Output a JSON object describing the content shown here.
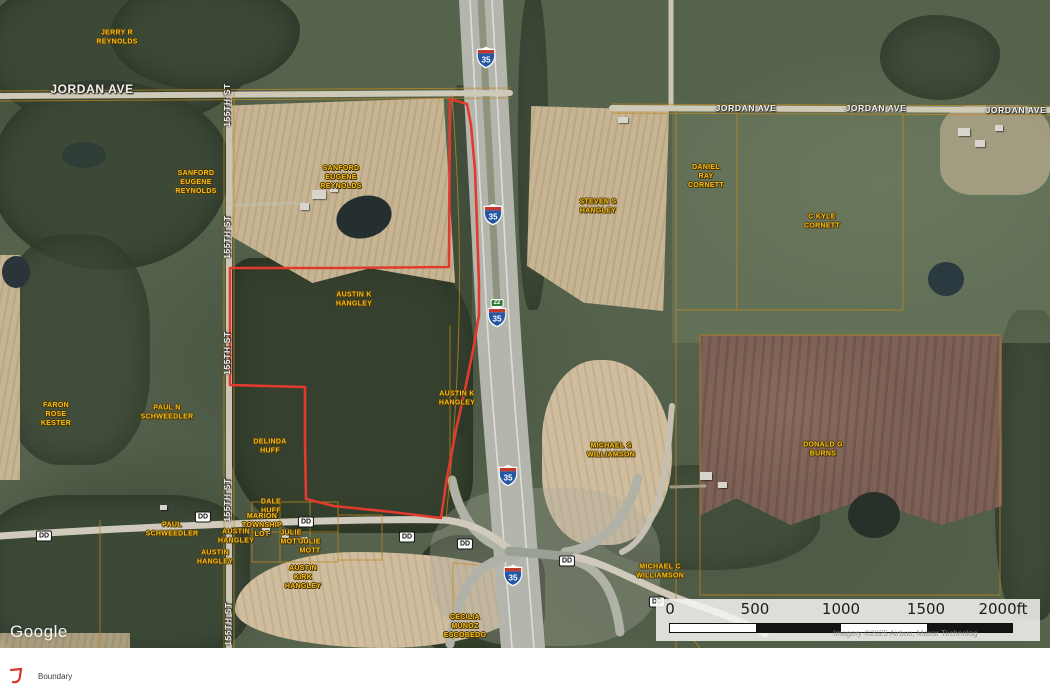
{
  "map": {
    "google_watermark": "Google",
    "attribution": "Imagery ©2025 Airbus, Maxar Technolog",
    "owner_label_color": "#f2c01d",
    "owner_labels": [
      {
        "name": "parcel-label-jerry-r-reynolds",
        "text": "JERRY R\nREYNOLDS",
        "x": 117,
        "y": 38
      },
      {
        "name": "parcel-label-sanford-eugene-reynolds-1",
        "text": "SANFORD\nEUGENE\nREYNOLDS",
        "x": 196,
        "y": 183
      },
      {
        "name": "parcel-label-sanford-eugene-reynolds-2",
        "text": "SANFORD\nEUGENE\nREYNOLDS",
        "x": 341,
        "y": 178
      },
      {
        "name": "parcel-label-steven-s-hangley",
        "text": "STEVEN S\nHANGLEY",
        "x": 598,
        "y": 207
      },
      {
        "name": "parcel-label-daniel-ray-cornett",
        "text": "DANIEL\nRAY\nCORNETT",
        "x": 706,
        "y": 177
      },
      {
        "name": "parcel-label-c-kyle-cornett",
        "text": "C KYLE\nCORNETT",
        "x": 822,
        "y": 222
      },
      {
        "name": "parcel-label-austin-k-hangley-1",
        "text": "AUSTIN K\nHANGLEY",
        "x": 354,
        "y": 300
      },
      {
        "name": "parcel-label-austin-k-hangley-2",
        "text": "AUSTIN K\nHANGLEY",
        "x": 457,
        "y": 399
      },
      {
        "name": "parcel-label-michael-s-williamson",
        "text": "MICHAEL S\nWILLIAMSON",
        "x": 611,
        "y": 451
      },
      {
        "name": "parcel-label-donald-g-burns",
        "text": "DONALD G\nBURNS",
        "x": 823,
        "y": 450
      },
      {
        "name": "parcel-label-faron-rose-kester",
        "text": "FARON\nROSE\nKESTER",
        "x": 56,
        "y": 415
      },
      {
        "name": "parcel-label-paul-n-schweedler",
        "text": "PAUL N\nSCHWEEDLER",
        "x": 167,
        "y": 413
      },
      {
        "name": "parcel-label-delinda-huff",
        "text": "DELINDA\nHUFF",
        "x": 270,
        "y": 447
      },
      {
        "name": "parcel-label-dale-huff",
        "text": "DALE\nHUFF",
        "x": 271,
        "y": 507
      },
      {
        "name": "parcel-label-paul-schweedler",
        "text": "PAUL\nSCHWEEDLER",
        "x": 172,
        "y": 530
      },
      {
        "name": "parcel-label-marion-township-lot",
        "text": "MARION\nTOWNSHIP\nLOT",
        "x": 262,
        "y": 526
      },
      {
        "name": "parcel-label-austin-hangley-1",
        "text": "AUSTIN\nHANGLEY",
        "x": 236,
        "y": 537
      },
      {
        "name": "parcel-label-julie-mott-1",
        "text": "JULIE\nMOTT",
        "x": 291,
        "y": 538
      },
      {
        "name": "parcel-label-julie-mott-2",
        "text": "JULIE\nMOTT",
        "x": 310,
        "y": 547
      },
      {
        "name": "parcel-label-austin-hangley-2",
        "text": "AUSTIN\nHANGLEY",
        "x": 215,
        "y": 558
      },
      {
        "name": "parcel-label-austin-kirk-hangley",
        "text": "AUSTIN\nKIRK\nHANGLEY",
        "x": 303,
        "y": 578
      },
      {
        "name": "parcel-label-michael-c-williamson",
        "text": "MICHAEL C\nWILLIAMSON",
        "x": 660,
        "y": 572
      },
      {
        "name": "parcel-label-cecilia-munoz-escobedo",
        "text": "CECILIA\nMUNOZ\nESCOBEDO",
        "x": 465,
        "y": 627
      }
    ],
    "road_labels": [
      {
        "name": "road-label-jordan-ave-west",
        "text": "JORDAN AVE",
        "x": 92,
        "y": 89,
        "size": 12,
        "rotate": 0
      },
      {
        "name": "road-label-jordan-ave-east-1",
        "text": "JORDAN AVE",
        "x": 746,
        "y": 108,
        "size": 8.5,
        "rotate": 0
      },
      {
        "name": "road-label-jordan-ave-east-2",
        "text": "JORDAN AVE",
        "x": 876,
        "y": 108,
        "size": 8.5,
        "rotate": 0
      },
      {
        "name": "road-label-jordan-ave-east-3",
        "text": "JORDAN AVE",
        "x": 1016,
        "y": 110,
        "size": 8.5,
        "rotate": 0
      },
      {
        "name": "road-label-155th-st-1",
        "text": "155TH ST",
        "x": 227,
        "y": 105,
        "size": 8.5,
        "rotate": -90
      },
      {
        "name": "road-label-155th-st-2",
        "text": "155TH ST",
        "x": 227,
        "y": 237,
        "size": 8.5,
        "rotate": -90
      },
      {
        "name": "road-label-155th-st-3",
        "text": "155TH ST",
        "x": 227,
        "y": 353,
        "size": 8.5,
        "rotate": -90
      },
      {
        "name": "road-label-155th-st-4",
        "text": "155TH ST",
        "x": 227,
        "y": 500,
        "size": 8.5,
        "rotate": -90
      },
      {
        "name": "road-label-155th-st-5",
        "text": "155TH ST",
        "x": 228,
        "y": 624,
        "size": 8.5,
        "rotate": -90
      }
    ],
    "dd_badge_label": "DD",
    "dd_badges": [
      {
        "x": 44,
        "y": 536
      },
      {
        "x": 203,
        "y": 517
      },
      {
        "x": 306,
        "y": 522
      },
      {
        "x": 407,
        "y": 537
      },
      {
        "x": 465,
        "y": 544
      },
      {
        "x": 567,
        "y": 561
      },
      {
        "x": 657,
        "y": 602
      }
    ],
    "interstate_shield": {
      "route": "35"
    },
    "interstate_shield_positions": [
      {
        "x": 486,
        "y": 60
      },
      {
        "x": 493,
        "y": 217
      },
      {
        "x": 497,
        "y": 319
      },
      {
        "x": 508,
        "y": 478
      },
      {
        "x": 513,
        "y": 578
      }
    ],
    "exit_badge": {
      "label": "22",
      "x": 497,
      "y": 303
    },
    "boundary": {
      "color": "#e23b2e",
      "points": [
        [
          450,
          99
        ],
        [
          467,
          104
        ],
        [
          471,
          125
        ],
        [
          475,
          170
        ],
        [
          477,
          225
        ],
        [
          479,
          285
        ],
        [
          479,
          315
        ],
        [
          474,
          345
        ],
        [
          466,
          385
        ],
        [
          456,
          430
        ],
        [
          447,
          478
        ],
        [
          441,
          518
        ],
        [
          392,
          512
        ],
        [
          334,
          506
        ],
        [
          306,
          499
        ],
        [
          305,
          440
        ],
        [
          305,
          387
        ],
        [
          266,
          386
        ],
        [
          230,
          385
        ],
        [
          230,
          330
        ],
        [
          230,
          268
        ],
        [
          340,
          268
        ],
        [
          449,
          267
        ]
      ]
    },
    "scale_bar": {
      "labels": [
        "0",
        "500",
        "1000",
        "1500",
        "2000ft"
      ],
      "label_x": [
        14,
        99,
        185,
        270,
        347
      ],
      "segment_colors": [
        "#ffffff",
        "#141414",
        "#ffffff",
        "#141414"
      ]
    }
  },
  "legend": {
    "label": "Boundary",
    "icon_color": "#d9372b"
  }
}
